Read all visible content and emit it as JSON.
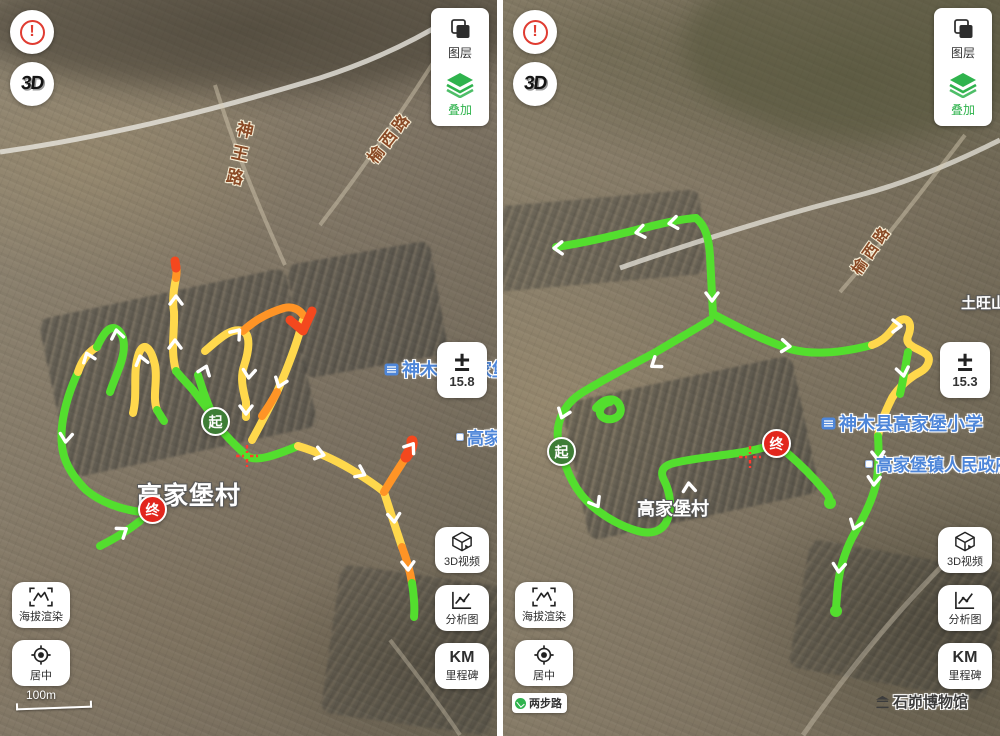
{
  "controls": {
    "warning_glyph": "!",
    "threed": "3D",
    "layers": "图层",
    "overlay": "叠加",
    "plusminus": "±",
    "video3d": "3D视频",
    "analysis": "分析图",
    "km": "KM",
    "milestone": "里程碑",
    "elevation": "海拔渲染",
    "center": "居中",
    "brand": "两步路"
  },
  "markers": {
    "start": "起",
    "end": "终"
  },
  "panels": [
    {
      "zoom_level": "15.8",
      "scale": "100m",
      "roads": {
        "shenwang": "神王路",
        "yuxi": "榆西路"
      },
      "places": {
        "village": "高家堡村",
        "school": "神木县高家堡小学",
        "government": "高家堡镇人民政府"
      }
    },
    {
      "zoom_level": "15.3",
      "roads": {
        "yuxi": "榆西路"
      },
      "places": {
        "village": "高家堡村",
        "school": "神木县高家堡小学",
        "government": "高家堡镇人民政府",
        "mountain": "土旺山",
        "museum": "石峁博物馆"
      }
    }
  ],
  "colors": {
    "track_green": "#53DE2E",
    "track_yellow": "#FFD84C",
    "track_orange": "#FF9426",
    "track_red": "#F4481E",
    "start_marker": "#3E7D36",
    "end_marker": "#E2261D",
    "overlay_green": "#2FB34D",
    "poi_blue": "#4E86D9",
    "road_text": "#8A4A26"
  }
}
